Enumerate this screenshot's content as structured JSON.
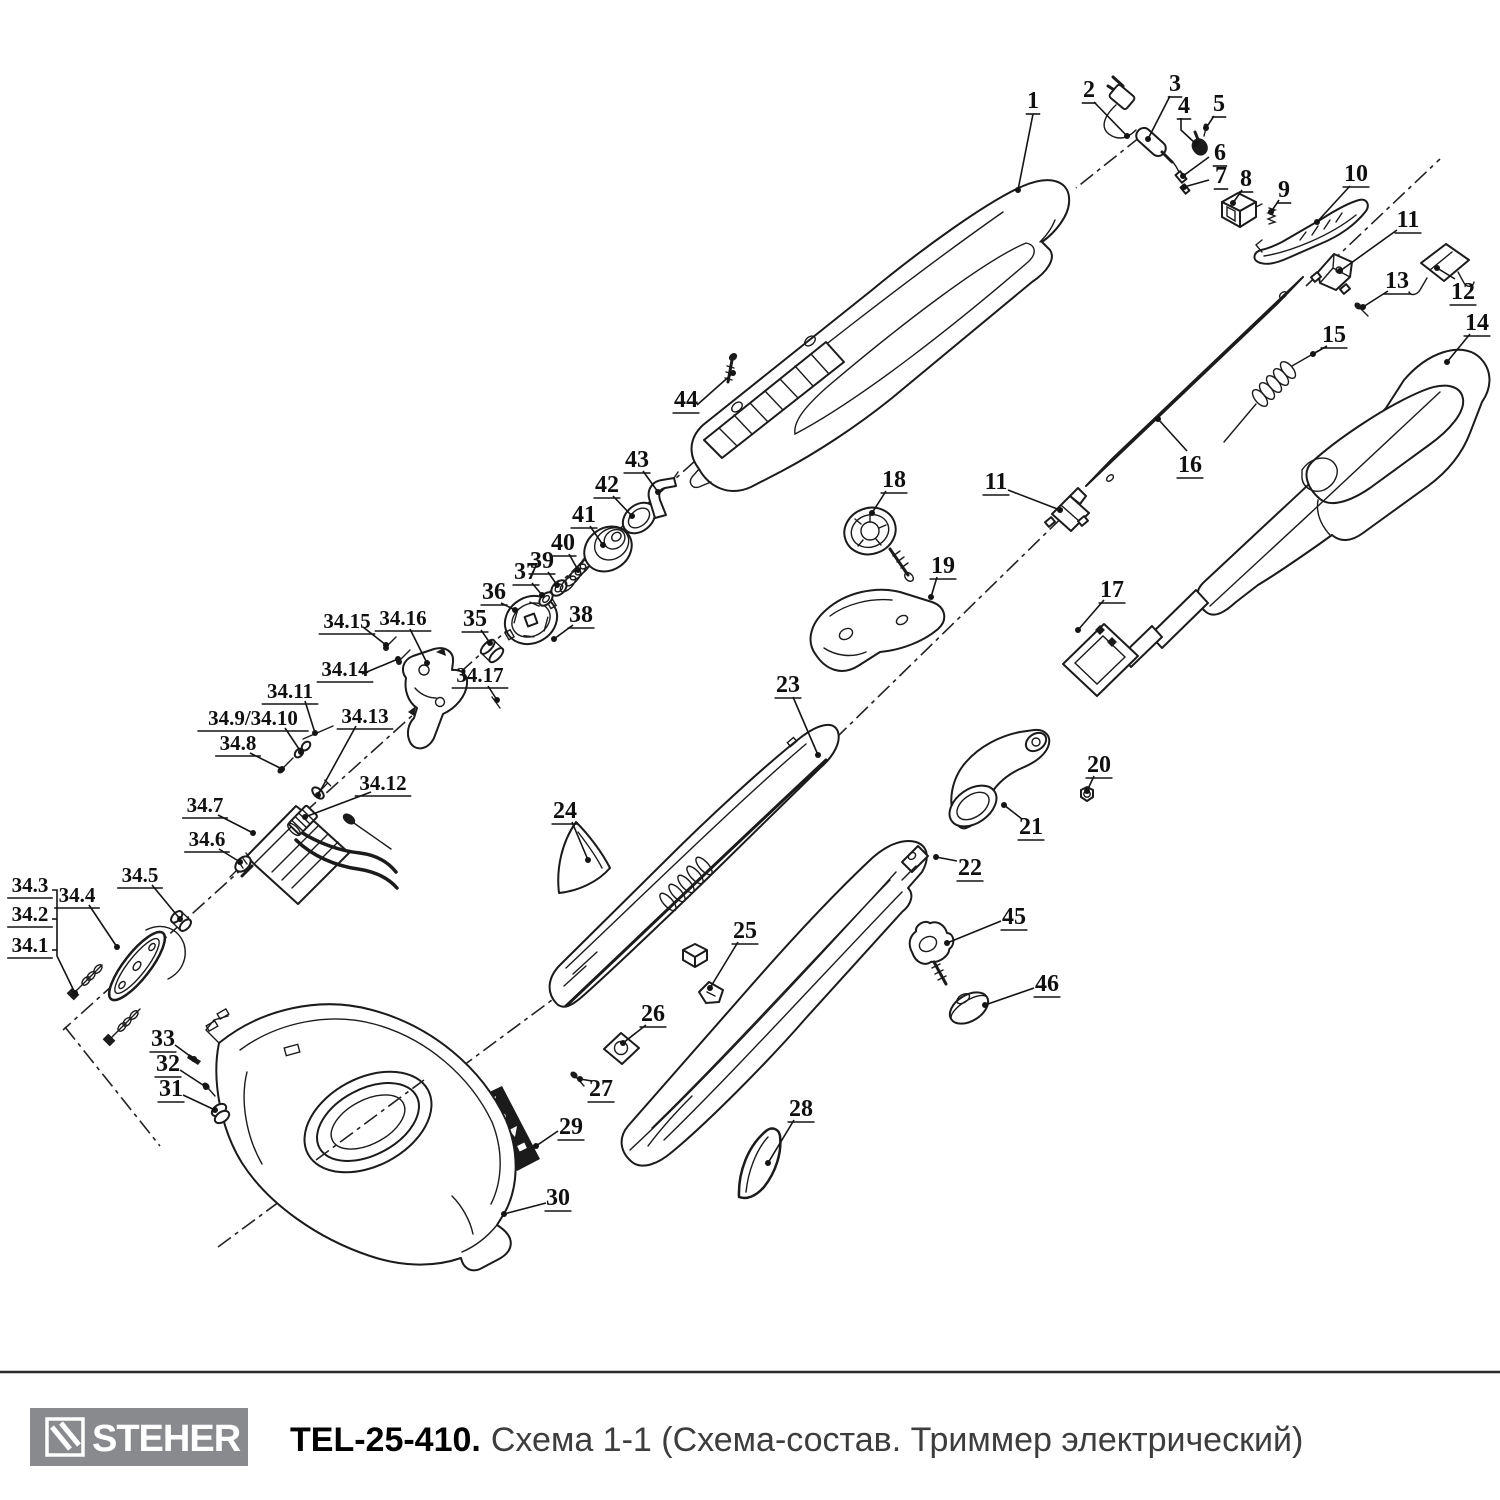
{
  "footer": {
    "brand": "STEHER",
    "model": "TEL-25-410.",
    "subtitle": "Схема 1-1 (Схема-состав. Триммер электрический)"
  },
  "diagram": {
    "labels": [
      {
        "t": "1",
        "x": 1033,
        "y": 100,
        "leader": [
          [
            1033,
            114
          ],
          [
            1018,
            190
          ]
        ]
      },
      {
        "t": "2",
        "x": 1089,
        "y": 89,
        "leader": [
          [
            1094,
            102
          ],
          [
            1127,
            136
          ]
        ]
      },
      {
        "t": "3",
        "x": 1175,
        "y": 83,
        "leader": [
          [
            1170,
            96
          ],
          [
            1148,
            139
          ]
        ]
      },
      {
        "t": "4",
        "x": 1184,
        "y": 105,
        "leader": [
          [
            1181,
            118
          ],
          [
            1181,
            130
          ],
          [
            1196,
            144
          ]
        ]
      },
      {
        "t": "5",
        "x": 1219,
        "y": 103,
        "leader": [
          [
            1214,
            116
          ],
          [
            1206,
            128
          ]
        ]
      },
      {
        "t": "6",
        "x": 1220,
        "y": 152,
        "leader": [
          [
            1209,
            157
          ],
          [
            1183,
            176
          ]
        ]
      },
      {
        "t": "7",
        "x": 1221,
        "y": 175,
        "leader": [
          [
            1209,
            180
          ],
          [
            1184,
            187
          ]
        ]
      },
      {
        "t": "8",
        "x": 1246,
        "y": 178,
        "leader": [
          [
            1242,
            190
          ],
          [
            1233,
            203
          ]
        ]
      },
      {
        "t": "9",
        "x": 1284,
        "y": 189,
        "leader": [
          [
            1279,
            200
          ],
          [
            1271,
            212
          ]
        ]
      },
      {
        "t": "10",
        "x": 1356,
        "y": 173,
        "leader": [
          [
            1350,
            186
          ],
          [
            1317,
            222
          ]
        ]
      },
      {
        "t": "11",
        "x": 1408,
        "y": 219,
        "leader": [
          [
            1397,
            230
          ],
          [
            1340,
            271
          ]
        ]
      },
      {
        "t": "12",
        "x": 1463,
        "y": 291,
        "leader": [
          [
            1455,
            279
          ],
          [
            1437,
            268
          ]
        ]
      },
      {
        "t": "13",
        "x": 1397,
        "y": 280,
        "leader": [
          [
            1388,
            291
          ],
          [
            1363,
            307
          ]
        ]
      },
      {
        "t": "14",
        "x": 1477,
        "y": 322,
        "leader": [
          [
            1470,
            334
          ],
          [
            1447,
            362
          ]
        ]
      },
      {
        "t": "15",
        "x": 1334,
        "y": 334,
        "leader": [
          [
            1327,
            346
          ],
          [
            1313,
            354
          ]
        ]
      },
      {
        "t": "16",
        "x": 1190,
        "y": 464,
        "leader": [
          [
            1187,
            451
          ],
          [
            1158,
            419
          ]
        ]
      },
      {
        "t": "17",
        "x": 1112,
        "y": 589,
        "leader": [
          [
            1104,
            600
          ],
          [
            1078,
            630
          ]
        ]
      },
      {
        "t": "18",
        "x": 894,
        "y": 479,
        "leader": [
          [
            886,
            491
          ],
          [
            872,
            513
          ]
        ]
      },
      {
        "t": "11",
        "x": 996,
        "y": 481,
        "leader": [
          [
            1008,
            490
          ],
          [
            1060,
            510
          ]
        ]
      },
      {
        "t": "19",
        "x": 943,
        "y": 565,
        "leader": [
          [
            937,
            577
          ],
          [
            931,
            597
          ]
        ]
      },
      {
        "t": "20",
        "x": 1099,
        "y": 764,
        "leader": [
          [
            1094,
            776
          ],
          [
            1087,
            791
          ]
        ]
      },
      {
        "t": "21",
        "x": 1031,
        "y": 826,
        "leader": [
          [
            1022,
            819
          ],
          [
            1004,
            805
          ]
        ]
      },
      {
        "t": "22",
        "x": 970,
        "y": 867,
        "leader": [
          [
            957,
            861
          ],
          [
            936,
            857
          ]
        ]
      },
      {
        "t": "23",
        "x": 788,
        "y": 684,
        "leader": [
          [
            793,
            697
          ],
          [
            818,
            755
          ]
        ]
      },
      {
        "t": "24",
        "x": 565,
        "y": 810,
        "leader": [
          [
            572,
            822
          ],
          [
            588,
            860
          ]
        ]
      },
      {
        "t": "25",
        "x": 745,
        "y": 930,
        "leader": [
          [
            738,
            942
          ],
          [
            710,
            988
          ]
        ]
      },
      {
        "t": "26",
        "x": 653,
        "y": 1013,
        "leader": [
          [
            646,
            1025
          ],
          [
            623,
            1043
          ]
        ]
      },
      {
        "t": "27",
        "x": 601,
        "y": 1088,
        "leader": [
          [
            592,
            1081
          ],
          [
            580,
            1079
          ]
        ]
      },
      {
        "t": "28",
        "x": 801,
        "y": 1108,
        "leader": [
          [
            794,
            1120
          ],
          [
            768,
            1163
          ]
        ]
      },
      {
        "t": "29",
        "x": 571,
        "y": 1126,
        "leader": [
          [
            558,
            1131
          ],
          [
            536,
            1146
          ]
        ]
      },
      {
        "t": "30",
        "x": 558,
        "y": 1197,
        "leader": [
          [
            546,
            1203
          ],
          [
            504,
            1214
          ]
        ]
      },
      {
        "t": "31",
        "x": 171,
        "y": 1088,
        "leader": [
          [
            183,
            1095
          ],
          [
            215,
            1110
          ]
        ]
      },
      {
        "t": "32",
        "x": 168,
        "y": 1063,
        "leader": [
          [
            180,
            1070
          ],
          [
            206,
            1087
          ]
        ]
      },
      {
        "t": "33",
        "x": 163,
        "y": 1038,
        "leader": [
          [
            175,
            1045
          ],
          [
            194,
            1059
          ]
        ]
      },
      {
        "t": "34.3",
        "x": 30,
        "y": 884,
        "fs": 21,
        "leader": [
          [
            52,
            890
          ],
          [
            57,
            890
          ],
          [
            57,
            956
          ],
          [
            75,
            993
          ]
        ]
      },
      {
        "t": "34.2",
        "x": 30,
        "y": 913,
        "fs": 21,
        "leader": [
          [
            52,
            919
          ],
          [
            57,
            919
          ]
        ],
        "dot": false
      },
      {
        "t": "34.1",
        "x": 30,
        "y": 944,
        "fs": 21,
        "leader": [
          [
            52,
            950
          ],
          [
            57,
            950
          ]
        ],
        "dot": false
      },
      {
        "t": "34.4",
        "x": 77,
        "y": 894,
        "fs": 21,
        "leader": [
          [
            89,
            905
          ],
          [
            117,
            947
          ]
        ]
      },
      {
        "t": "34.5",
        "x": 140,
        "y": 874,
        "fs": 21,
        "leader": [
          [
            152,
            885
          ],
          [
            180,
            919
          ]
        ]
      },
      {
        "t": "34.6",
        "x": 207,
        "y": 838,
        "fs": 21,
        "leader": [
          [
            219,
            849
          ],
          [
            240,
            862
          ]
        ]
      },
      {
        "t": "34.7",
        "x": 205,
        "y": 804,
        "fs": 21,
        "leader": [
          [
            218,
            815
          ],
          [
            253,
            833
          ]
        ]
      },
      {
        "t": "34.8",
        "x": 238,
        "y": 742,
        "fs": 21,
        "leader": [
          [
            250,
            753
          ],
          [
            282,
            769
          ]
        ]
      },
      {
        "t": "34.9/34.10",
        "x": 253,
        "y": 717,
        "fs": 21,
        "leader": [
          [
            285,
            728
          ],
          [
            301,
            752
          ]
        ]
      },
      {
        "t": "34.11",
        "x": 290,
        "y": 690,
        "fs": 21,
        "leader": [
          [
            305,
            701
          ],
          [
            315,
            733
          ]
        ]
      },
      {
        "t": "34.13",
        "x": 365,
        "y": 715,
        "fs": 21,
        "leader": [
          [
            356,
            726
          ],
          [
            318,
            795
          ]
        ]
      },
      {
        "t": "34.12",
        "x": 383,
        "y": 782,
        "fs": 21,
        "leader": [
          [
            371,
            792
          ],
          [
            305,
            817
          ]
        ]
      },
      {
        "t": "34.14",
        "x": 345,
        "y": 668,
        "fs": 21,
        "leader": [
          [
            362,
            674
          ],
          [
            398,
            659
          ]
        ]
      },
      {
        "t": "34.15",
        "x": 347,
        "y": 620,
        "fs": 21,
        "leader": [
          [
            363,
            627
          ],
          [
            386,
            645
          ]
        ]
      },
      {
        "t": "34.16",
        "x": 403,
        "y": 617,
        "fs": 21,
        "leader": [
          [
            410,
            629
          ],
          [
            427,
            663
          ]
        ]
      },
      {
        "t": "34.17",
        "x": 480,
        "y": 674,
        "fs": 21,
        "leader": [
          [
            488,
            686
          ],
          [
            497,
            700
          ]
        ]
      },
      {
        "t": "35",
        "x": 475,
        "y": 618,
        "leader": [
          [
            481,
            630
          ],
          [
            490,
            643
          ]
        ]
      },
      {
        "t": "36",
        "x": 494,
        "y": 591,
        "leader": [
          [
            501,
            603
          ],
          [
            515,
            610
          ]
        ]
      },
      {
        "t": "37",
        "x": 526,
        "y": 571,
        "leader": [
          [
            532,
            583
          ],
          [
            542,
            595
          ]
        ]
      },
      {
        "t": "38",
        "x": 581,
        "y": 614,
        "leader": [
          [
            573,
            625
          ],
          [
            554,
            639
          ]
        ]
      },
      {
        "t": "39",
        "x": 542,
        "y": 560,
        "leader": [
          [
            548,
            572
          ],
          [
            557,
            585
          ]
        ]
      },
      {
        "t": "40",
        "x": 563,
        "y": 542,
        "leader": [
          [
            569,
            554
          ],
          [
            578,
            570
          ]
        ]
      },
      {
        "t": "41",
        "x": 584,
        "y": 514,
        "leader": [
          [
            590,
            526
          ],
          [
            603,
            545
          ]
        ]
      },
      {
        "t": "42",
        "x": 607,
        "y": 484,
        "leader": [
          [
            613,
            496
          ],
          [
            632,
            516
          ]
        ]
      },
      {
        "t": "43",
        "x": 637,
        "y": 459,
        "leader": [
          [
            643,
            471
          ],
          [
            658,
            492
          ]
        ]
      },
      {
        "t": "44",
        "x": 686,
        "y": 399,
        "leader": [
          [
            697,
            405
          ],
          [
            733,
            373
          ]
        ]
      },
      {
        "t": "45",
        "x": 1014,
        "y": 916,
        "leader": [
          [
            1001,
            921
          ],
          [
            947,
            943
          ]
        ]
      },
      {
        "t": "46",
        "x": 1047,
        "y": 983,
        "leader": [
          [
            1034,
            988
          ],
          [
            985,
            1005
          ]
        ]
      }
    ]
  }
}
